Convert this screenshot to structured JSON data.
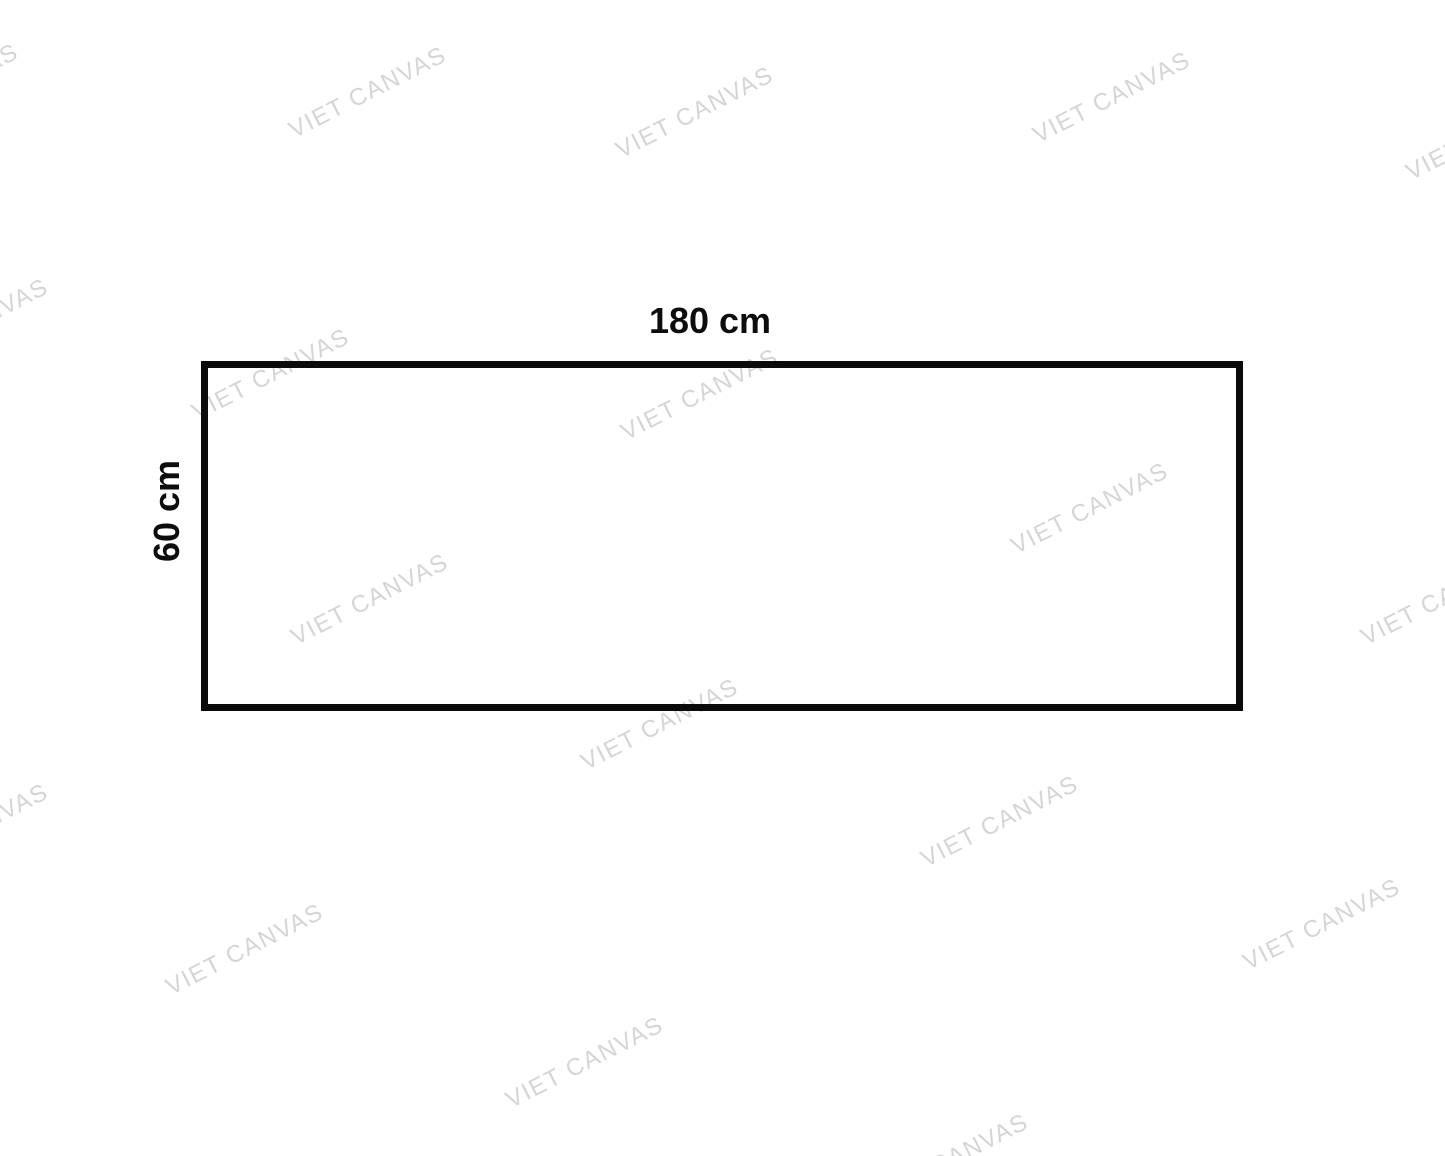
{
  "page": {
    "background_color": "#ffffff",
    "kind": "canvas-size-diagram"
  },
  "diagram": {
    "shape": "rectangle",
    "border_color": "#0a0a0a",
    "width_label": "180 cm",
    "height_label": "60 cm"
  },
  "watermark": {
    "text": "VIET CANVAS",
    "color": "#d5d5d5",
    "angle_deg": -27,
    "positions": [
      {
        "x": -60,
        "y": 90
      },
      {
        "x": 368,
        "y": 93
      },
      {
        "x": 695,
        "y": 113
      },
      {
        "x": 1112,
        "y": 98
      },
      {
        "x": 1485,
        "y": 135
      },
      {
        "x": -30,
        "y": 325
      },
      {
        "x": 271,
        "y": 375
      },
      {
        "x": 700,
        "y": 395
      },
      {
        "x": 1090,
        "y": 509
      },
      {
        "x": 1440,
        "y": 600
      },
      {
        "x": 370,
        "y": 600
      },
      {
        "x": 660,
        "y": 725
      },
      {
        "x": -30,
        "y": 830
      },
      {
        "x": 1000,
        "y": 822
      },
      {
        "x": 1322,
        "y": 925
      },
      {
        "x": 245,
        "y": 950
      },
      {
        "x": 585,
        "y": 1063
      },
      {
        "x": 950,
        "y": 1160
      }
    ]
  }
}
